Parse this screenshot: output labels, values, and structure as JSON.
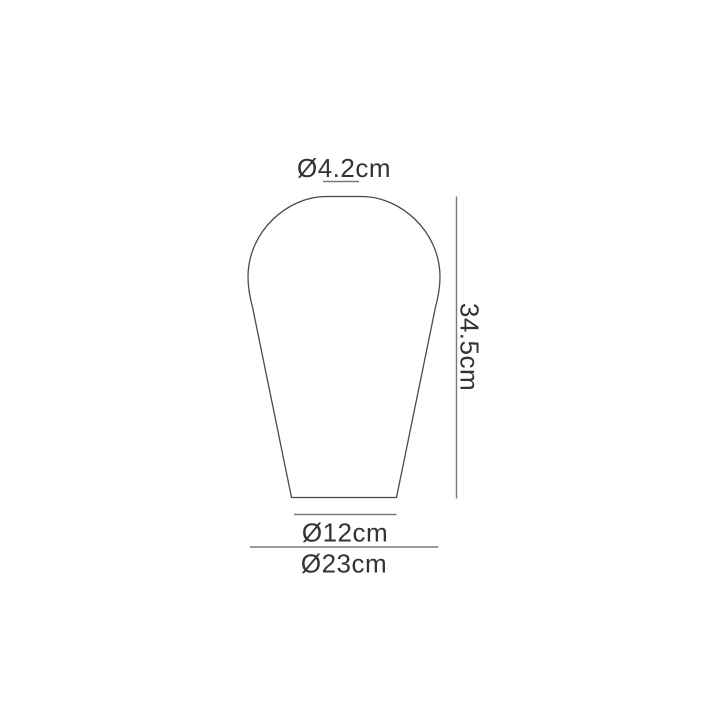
{
  "diagram": {
    "title": "Shade dimension diagram",
    "shape": "pear-shaped shade outline",
    "dimensions": {
      "top_diameter": {
        "label": "Ø4.2cm",
        "value_cm": 4.2
      },
      "height": {
        "label": "34.5cm",
        "value_cm": 34.5
      },
      "base_diameter": {
        "label": "Ø12cm",
        "value_cm": 12
      },
      "max_diameter": {
        "label": "Ø23cm",
        "value_cm": 23
      }
    },
    "colors": {
      "background": "#ffffff",
      "outline": "#4a4a4a",
      "dimension_lines": "#7a7a7a",
      "text": "#333333"
    }
  }
}
